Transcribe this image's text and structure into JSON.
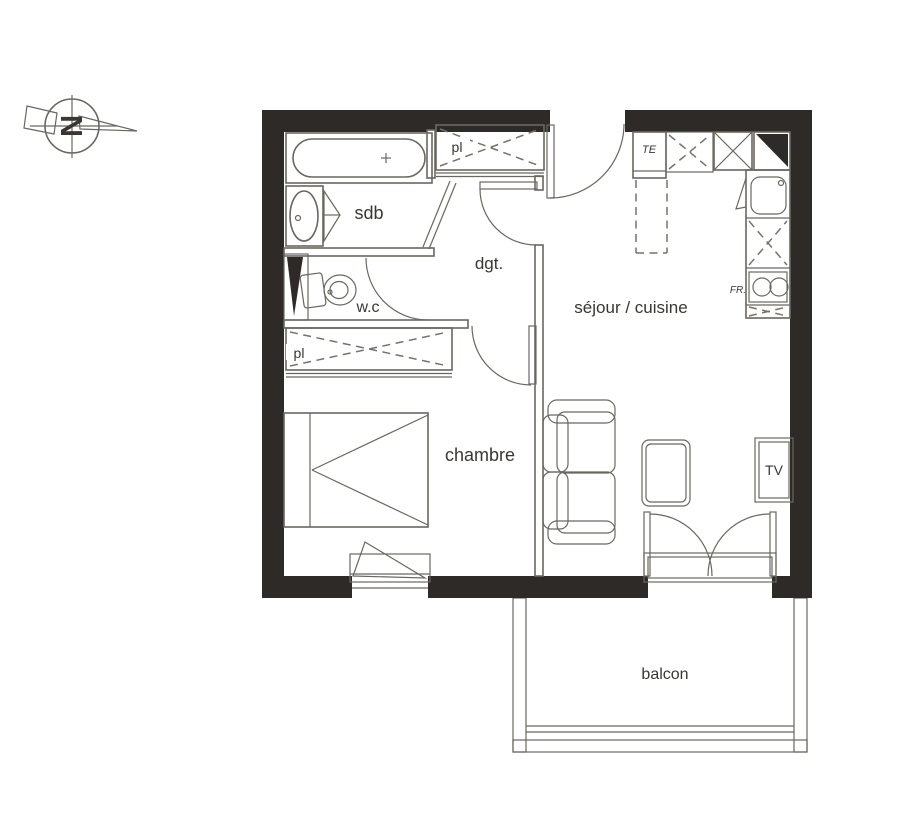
{
  "colors": {
    "wall": "#2e2a27",
    "line": "#6b675f",
    "text": "#3a3732",
    "background": "#ffffff"
  },
  "compass": {
    "north_letter": "N"
  },
  "rooms": {
    "bathroom": "sdb",
    "toilet": "w.c",
    "hallway": "dgt.",
    "living_kitchen": "séjour / cuisine",
    "bedroom": "chambre",
    "balcony": "balcon"
  },
  "closets": {
    "entry_closet": "pl",
    "bedroom_closet": "pl"
  },
  "appliances": {
    "electrical_panel": "TE",
    "stove": "FR.",
    "tv": "TV"
  }
}
